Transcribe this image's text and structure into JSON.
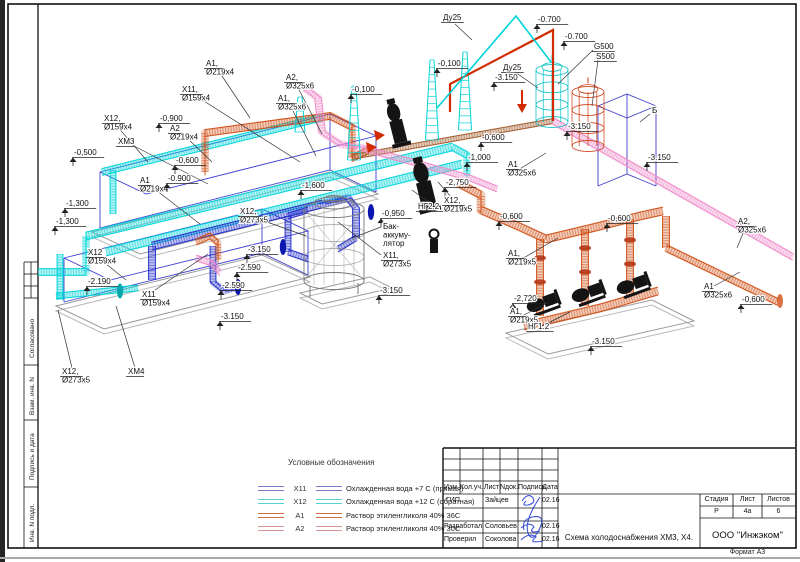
{
  "sheet": {
    "format_note": "Формат А3"
  },
  "side_stamp": {
    "items": [
      "Согласовано",
      "Взам. инв. N",
      "Подпись и дата",
      "Инв. N подл."
    ]
  },
  "legend": {
    "title": "Условные обозначения",
    "items": [
      {
        "tag": "Х11",
        "desc": "Охлажденная вода +7 С (прямая)",
        "color": "#7b7bd0"
      },
      {
        "tag": "Х12",
        "desc": "Охлажденная вода +12 С (обратная)",
        "color": "#55d2d2"
      },
      {
        "tag": "А1",
        "desc": "Раствор этиленгликоля 40% 36С",
        "color": "#cf6f3e"
      },
      {
        "tag": "А2",
        "desc": "Раствор этиленгликоля 40% 30С",
        "color": "#dd9494"
      }
    ]
  },
  "title_block": {
    "header_cols": [
      "Изм.",
      "Кол.уч.",
      "Лист",
      "Nдок.",
      "Подпись",
      "Дата"
    ],
    "rows": [
      {
        "role": "ГИП",
        "name": "Зайцев",
        "date": "02.16"
      },
      {
        "role": "Разработал",
        "name": "Соловьев",
        "date": "02.16"
      },
      {
        "role": "Проверил",
        "name": "Соколова",
        "date": "02.16"
      }
    ],
    "doc_title": "Схема холодоснабжения ХМ3, Х4.",
    "stage_label": "Стадия",
    "sheet_label": "Лист",
    "sheets_label": "Листов",
    "stage": "Р",
    "sheet": "4а",
    "sheets": "6",
    "company": "ООО \"Инжэком\""
  },
  "diagram": {
    "colors": {
      "x11": "#2330cc",
      "x12": "#00d4d8",
      "a1": "#cf4e14",
      "a2": "#ef8cc9",
      "red": "#d22b00",
      "brown": "#a05a2a"
    },
    "labels": [
      {
        "t": "t",
        "x": 443,
        "y": 20,
        "lines": [
          "Ду25"
        ]
      },
      {
        "t": "e",
        "x": 538,
        "y": 22,
        "lines": [
          "-0.700"
        ]
      },
      {
        "t": "e",
        "x": 565,
        "y": 39,
        "lines": [
          "-0.700"
        ]
      },
      {
        "t": "t",
        "x": 594,
        "y": 49,
        "lines": [
          "G500"
        ]
      },
      {
        "t": "t",
        "x": 596,
        "y": 59,
        "lines": [
          "S500"
        ]
      },
      {
        "t": "t",
        "x": 503,
        "y": 70,
        "lines": [
          "Ду25"
        ]
      },
      {
        "t": "e",
        "x": 495,
        "y": 80,
        "lines": [
          "-3.150"
        ]
      },
      {
        "t": "e",
        "x": 438,
        "y": 66,
        "lines": [
          "-0,100"
        ]
      },
      {
        "t": "e",
        "x": 352,
        "y": 92,
        "lines": [
          "-0,100"
        ]
      },
      {
        "t": "t",
        "x": 206,
        "y": 66,
        "lines": [
          "A1,",
          "Ø219x4"
        ]
      },
      {
        "t": "t",
        "x": 182,
        "y": 92,
        "lines": [
          "X11,",
          "Ø159x4"
        ]
      },
      {
        "t": "t",
        "x": 286,
        "y": 80,
        "lines": [
          "A2,",
          "Ø325x6"
        ]
      },
      {
        "t": "t",
        "x": 278,
        "y": 101,
        "lines": [
          "A1,",
          "Ø325x6"
        ]
      },
      {
        "t": "t",
        "x": 104,
        "y": 121,
        "lines": [
          "X12,",
          "Ø159x4"
        ]
      },
      {
        "t": "t",
        "x": 170,
        "y": 131,
        "lines": [
          "A2",
          "Ø219x4"
        ]
      },
      {
        "t": "e",
        "x": 160,
        "y": 121,
        "lines": [
          "-0,900"
        ]
      },
      {
        "t": "t",
        "x": 118,
        "y": 144,
        "lines": [
          "ХМ3"
        ]
      },
      {
        "t": "e",
        "x": 74,
        "y": 155,
        "lines": [
          "-0,500"
        ]
      },
      {
        "t": "e",
        "x": 176,
        "y": 163,
        "lines": [
          "-0,600"
        ]
      },
      {
        "t": "t",
        "x": 140,
        "y": 183,
        "lines": [
          "A1",
          "Ø219x4"
        ]
      },
      {
        "t": "e",
        "x": 168,
        "y": 181,
        "lines": [
          "-0.900"
        ]
      },
      {
        "t": "e",
        "x": 66,
        "y": 206,
        "lines": [
          "-1,300"
        ]
      },
      {
        "t": "e",
        "x": 56,
        "y": 224,
        "lines": [
          "-1,300"
        ]
      },
      {
        "t": "e",
        "x": 302,
        "y": 188,
        "lines": [
          "-1,600"
        ]
      },
      {
        "t": "t",
        "x": 240,
        "y": 214,
        "lines": [
          "X12,",
          "Ø273x5"
        ]
      },
      {
        "t": "e",
        "x": 382,
        "y": 216,
        "lines": [
          "-0,950"
        ]
      },
      {
        "t": "t",
        "x": 418,
        "y": 209,
        "lines": [
          "НГ2.2"
        ]
      },
      {
        "t": "t",
        "x": 444,
        "y": 203,
        "lines": [
          "X12,",
          "Ø219x5"
        ]
      },
      {
        "t": "e",
        "x": 446,
        "y": 185,
        "lines": [
          "-2,750"
        ]
      },
      {
        "t": "e",
        "x": 482,
        "y": 140,
        "lines": [
          "-0,600"
        ]
      },
      {
        "t": "e",
        "x": 468,
        "y": 160,
        "lines": [
          "-1,000"
        ]
      },
      {
        "t": "t",
        "x": 508,
        "y": 167,
        "lines": [
          "A1",
          "Ø325x6"
        ]
      },
      {
        "t": "e",
        "x": 568,
        "y": 129,
        "lines": [
          "-3.150"
        ]
      },
      {
        "t": "p",
        "x": 652,
        "y": 113,
        "lines": [
          "Б"
        ]
      },
      {
        "t": "e",
        "x": 648,
        "y": 160,
        "lines": [
          "-3.150"
        ]
      },
      {
        "t": "p",
        "x": 383,
        "y": 229,
        "lines": [
          "Бак-",
          "аккуму-",
          "лятор"
        ]
      },
      {
        "t": "t",
        "x": 383,
        "y": 258,
        "lines": [
          "X11,",
          "Ø273x5"
        ]
      },
      {
        "t": "e",
        "x": 380,
        "y": 293,
        "lines": [
          "-3.150"
        ]
      },
      {
        "t": "e",
        "x": 248,
        "y": 252,
        "lines": [
          "-3.150"
        ]
      },
      {
        "t": "e",
        "x": 238,
        "y": 270,
        "lines": [
          "-2.590"
        ]
      },
      {
        "t": "e",
        "x": 222,
        "y": 288,
        "lines": [
          "-2.590"
        ]
      },
      {
        "t": "e",
        "x": 221,
        "y": 319,
        "lines": [
          "-3.150"
        ]
      },
      {
        "t": "e",
        "x": 88,
        "y": 284,
        "lines": [
          "-2.190"
        ]
      },
      {
        "t": "t",
        "x": 88,
        "y": 255,
        "lines": [
          "X12",
          "Ø159x4"
        ]
      },
      {
        "t": "t",
        "x": 142,
        "y": 297,
        "lines": [
          "X11",
          "Ø159x4"
        ]
      },
      {
        "t": "t",
        "x": 62,
        "y": 374,
        "lines": [
          "X12,",
          "Ø273x5"
        ]
      },
      {
        "t": "t",
        "x": 128,
        "y": 374,
        "lines": [
          "ХМ4"
        ]
      },
      {
        "t": "e",
        "x": 500,
        "y": 219,
        "lines": [
          "-0,600"
        ]
      },
      {
        "t": "e",
        "x": 608,
        "y": 221,
        "lines": [
          "-0,600"
        ]
      },
      {
        "t": "t",
        "x": 508,
        "y": 256,
        "lines": [
          "A1,",
          "Ø219x5"
        ]
      },
      {
        "t": "e",
        "x": 514,
        "y": 301,
        "lines": [
          "-2,720"
        ]
      },
      {
        "t": "t",
        "x": 510,
        "y": 314,
        "lines": [
          "A1,",
          "Ø219x5"
        ]
      },
      {
        "t": "t",
        "x": 528,
        "y": 329,
        "lines": [
          "НГ1.2"
        ]
      },
      {
        "t": "e",
        "x": 592,
        "y": 344,
        "lines": [
          "-3.150"
        ]
      },
      {
        "t": "t",
        "x": 738,
        "y": 224,
        "lines": [
          "A2,",
          "Ø325x6"
        ]
      },
      {
        "t": "t",
        "x": 704,
        "y": 289,
        "lines": [
          "A1",
          "Ø325x6"
        ]
      },
      {
        "t": "e",
        "x": 742,
        "y": 302,
        "lines": [
          "-0,600"
        ]
      }
    ]
  }
}
